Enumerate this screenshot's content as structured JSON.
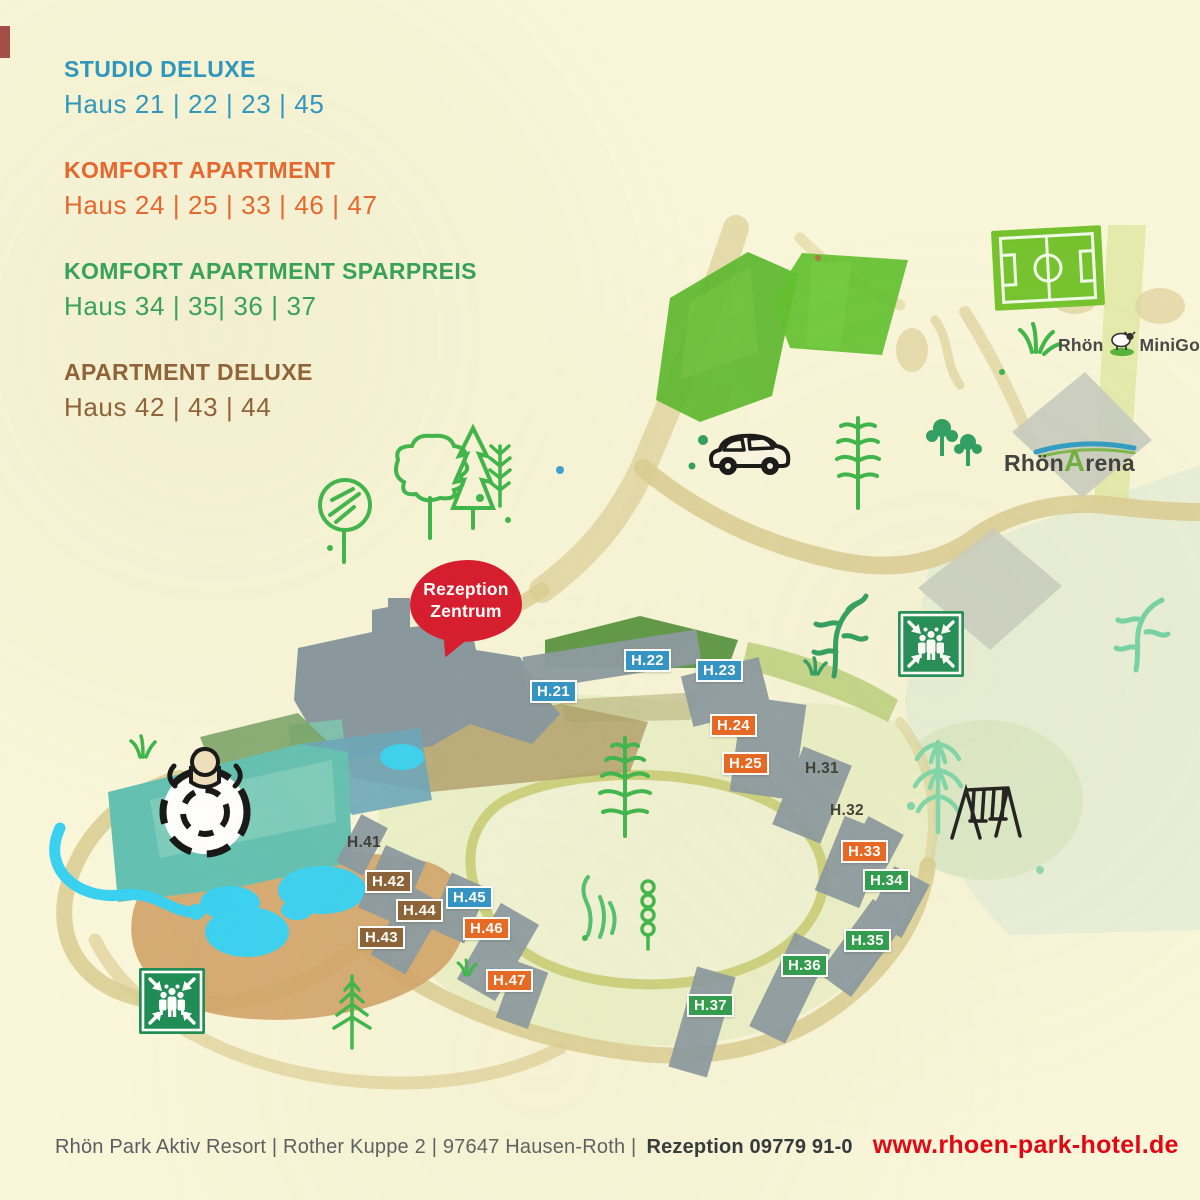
{
  "legend": {
    "groups": [
      {
        "title": "STUDIO DELUXE",
        "houses": "Haus 21 | 22 | 23 | 45",
        "color": "#2b96c0"
      },
      {
        "title": "KOMFORT APARTMENT",
        "houses": "Haus 24 | 25 | 33 | 46 | 47",
        "color": "#e8632c"
      },
      {
        "title": "KOMFORT APARTMENT SPARPREIS",
        "houses": "Haus 34 | 35|  36 | 37",
        "color": "#2ea156"
      },
      {
        "title": "APARTMENT DELUXE",
        "houses": "Haus 42 | 43 | 44",
        "color": "#8a5d33"
      }
    ]
  },
  "map": {
    "reception": {
      "line1": "Rezeption",
      "line2": "Zentrum",
      "color": "#d7182c"
    },
    "logos": {
      "minigolf": {
        "left": "Rhön",
        "right": "MiniGolf"
      },
      "arena": {
        "part1": "Rhön",
        "part2": "A",
        "part3": "rena"
      }
    },
    "house_badges": [
      {
        "text": "H.21",
        "category": "studio-deluxe"
      },
      {
        "text": "H.22",
        "category": "studio-deluxe"
      },
      {
        "text": "H.23",
        "category": "studio-deluxe"
      },
      {
        "text": "H.24",
        "category": "komfort-apartment"
      },
      {
        "text": "H.25",
        "category": "komfort-apartment"
      },
      {
        "text": "H.33",
        "category": "komfort-apartment"
      },
      {
        "text": "H.34",
        "category": "komfort-sparpreis"
      },
      {
        "text": "H.35",
        "category": "komfort-sparpreis"
      },
      {
        "text": "H.36",
        "category": "komfort-sparpreis"
      },
      {
        "text": "H.37",
        "category": "komfort-sparpreis"
      },
      {
        "text": "H.42",
        "category": "apartment-deluxe"
      },
      {
        "text": "H.44",
        "category": "apartment-deluxe"
      },
      {
        "text": "H.43",
        "category": "apartment-deluxe"
      },
      {
        "text": "H.45",
        "category": "studio-deluxe"
      },
      {
        "text": "H.46",
        "category": "komfort-apartment"
      },
      {
        "text": "H.47",
        "category": "komfort-apartment"
      }
    ],
    "plain_labels": [
      {
        "text": "H.31"
      },
      {
        "text": "H.32"
      },
      {
        "text": "H.41"
      }
    ]
  },
  "footer": {
    "address": "Rhön Park Aktiv Resort | Rother Kuppe 2 | 97647 Hausen-Roth |",
    "phone": "Rezeption 09779 91-0",
    "website": "www.rhoen-park-hotel.de",
    "website_color": "#e30613"
  },
  "colors": {
    "background": "#f9f6da",
    "studio_deluxe": "#2e93c6",
    "komfort_apartment": "#e8641f",
    "komfort_sparpreis": "#2b9b4c",
    "apartment_deluxe": "#8a5f35",
    "building": "#8a99a1",
    "road": "#dbcd92",
    "reception_red": "#d7182c",
    "pool_teal": "#63c1b2",
    "water_cyan": "#3ad1f1",
    "assembly_green": "#1e8c55"
  }
}
